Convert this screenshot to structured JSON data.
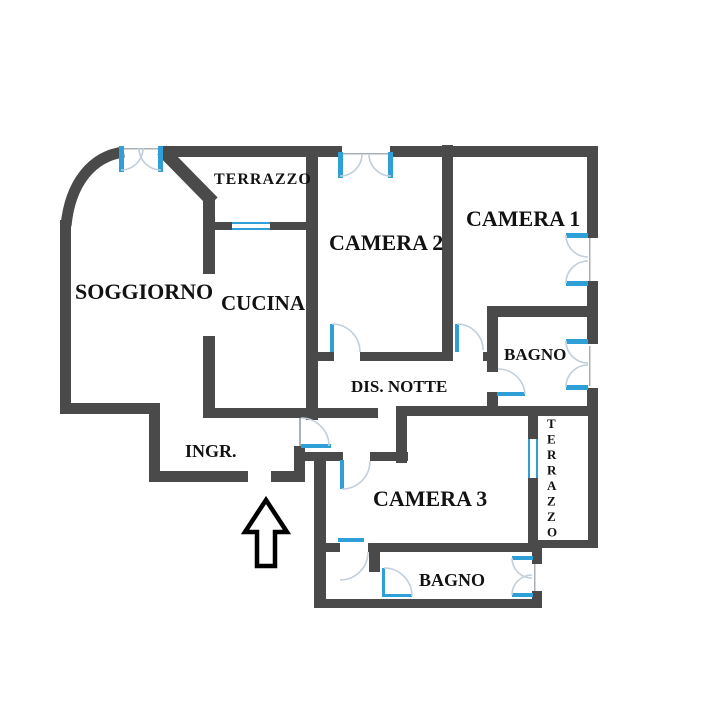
{
  "floorplan": {
    "title": "Apartment floor plan",
    "rooms": [
      {
        "id": "terrazzo-top",
        "label": "TERRAZZO"
      },
      {
        "id": "soggiorno",
        "label": "SOGGIORNO"
      },
      {
        "id": "cucina",
        "label": "CUCINA"
      },
      {
        "id": "camera-2",
        "label": "CAMERA 2"
      },
      {
        "id": "camera-1",
        "label": "CAMERA 1"
      },
      {
        "id": "bagno-1",
        "label": "BAGNO"
      },
      {
        "id": "dis-notte",
        "label": "DIS. NOTTE"
      },
      {
        "id": "ingresso",
        "label": "INGR."
      },
      {
        "id": "camera-3",
        "label": "CAMERA 3"
      },
      {
        "id": "terrazzo-right",
        "label": "TERRAZZO"
      },
      {
        "id": "bagno-2",
        "label": "BAGNO"
      }
    ],
    "colors": {
      "wall": "#4a4a4a",
      "door": "#2f9fd8",
      "arc": "#c2cfda",
      "text": "#121212",
      "background": "#ffffff"
    }
  }
}
